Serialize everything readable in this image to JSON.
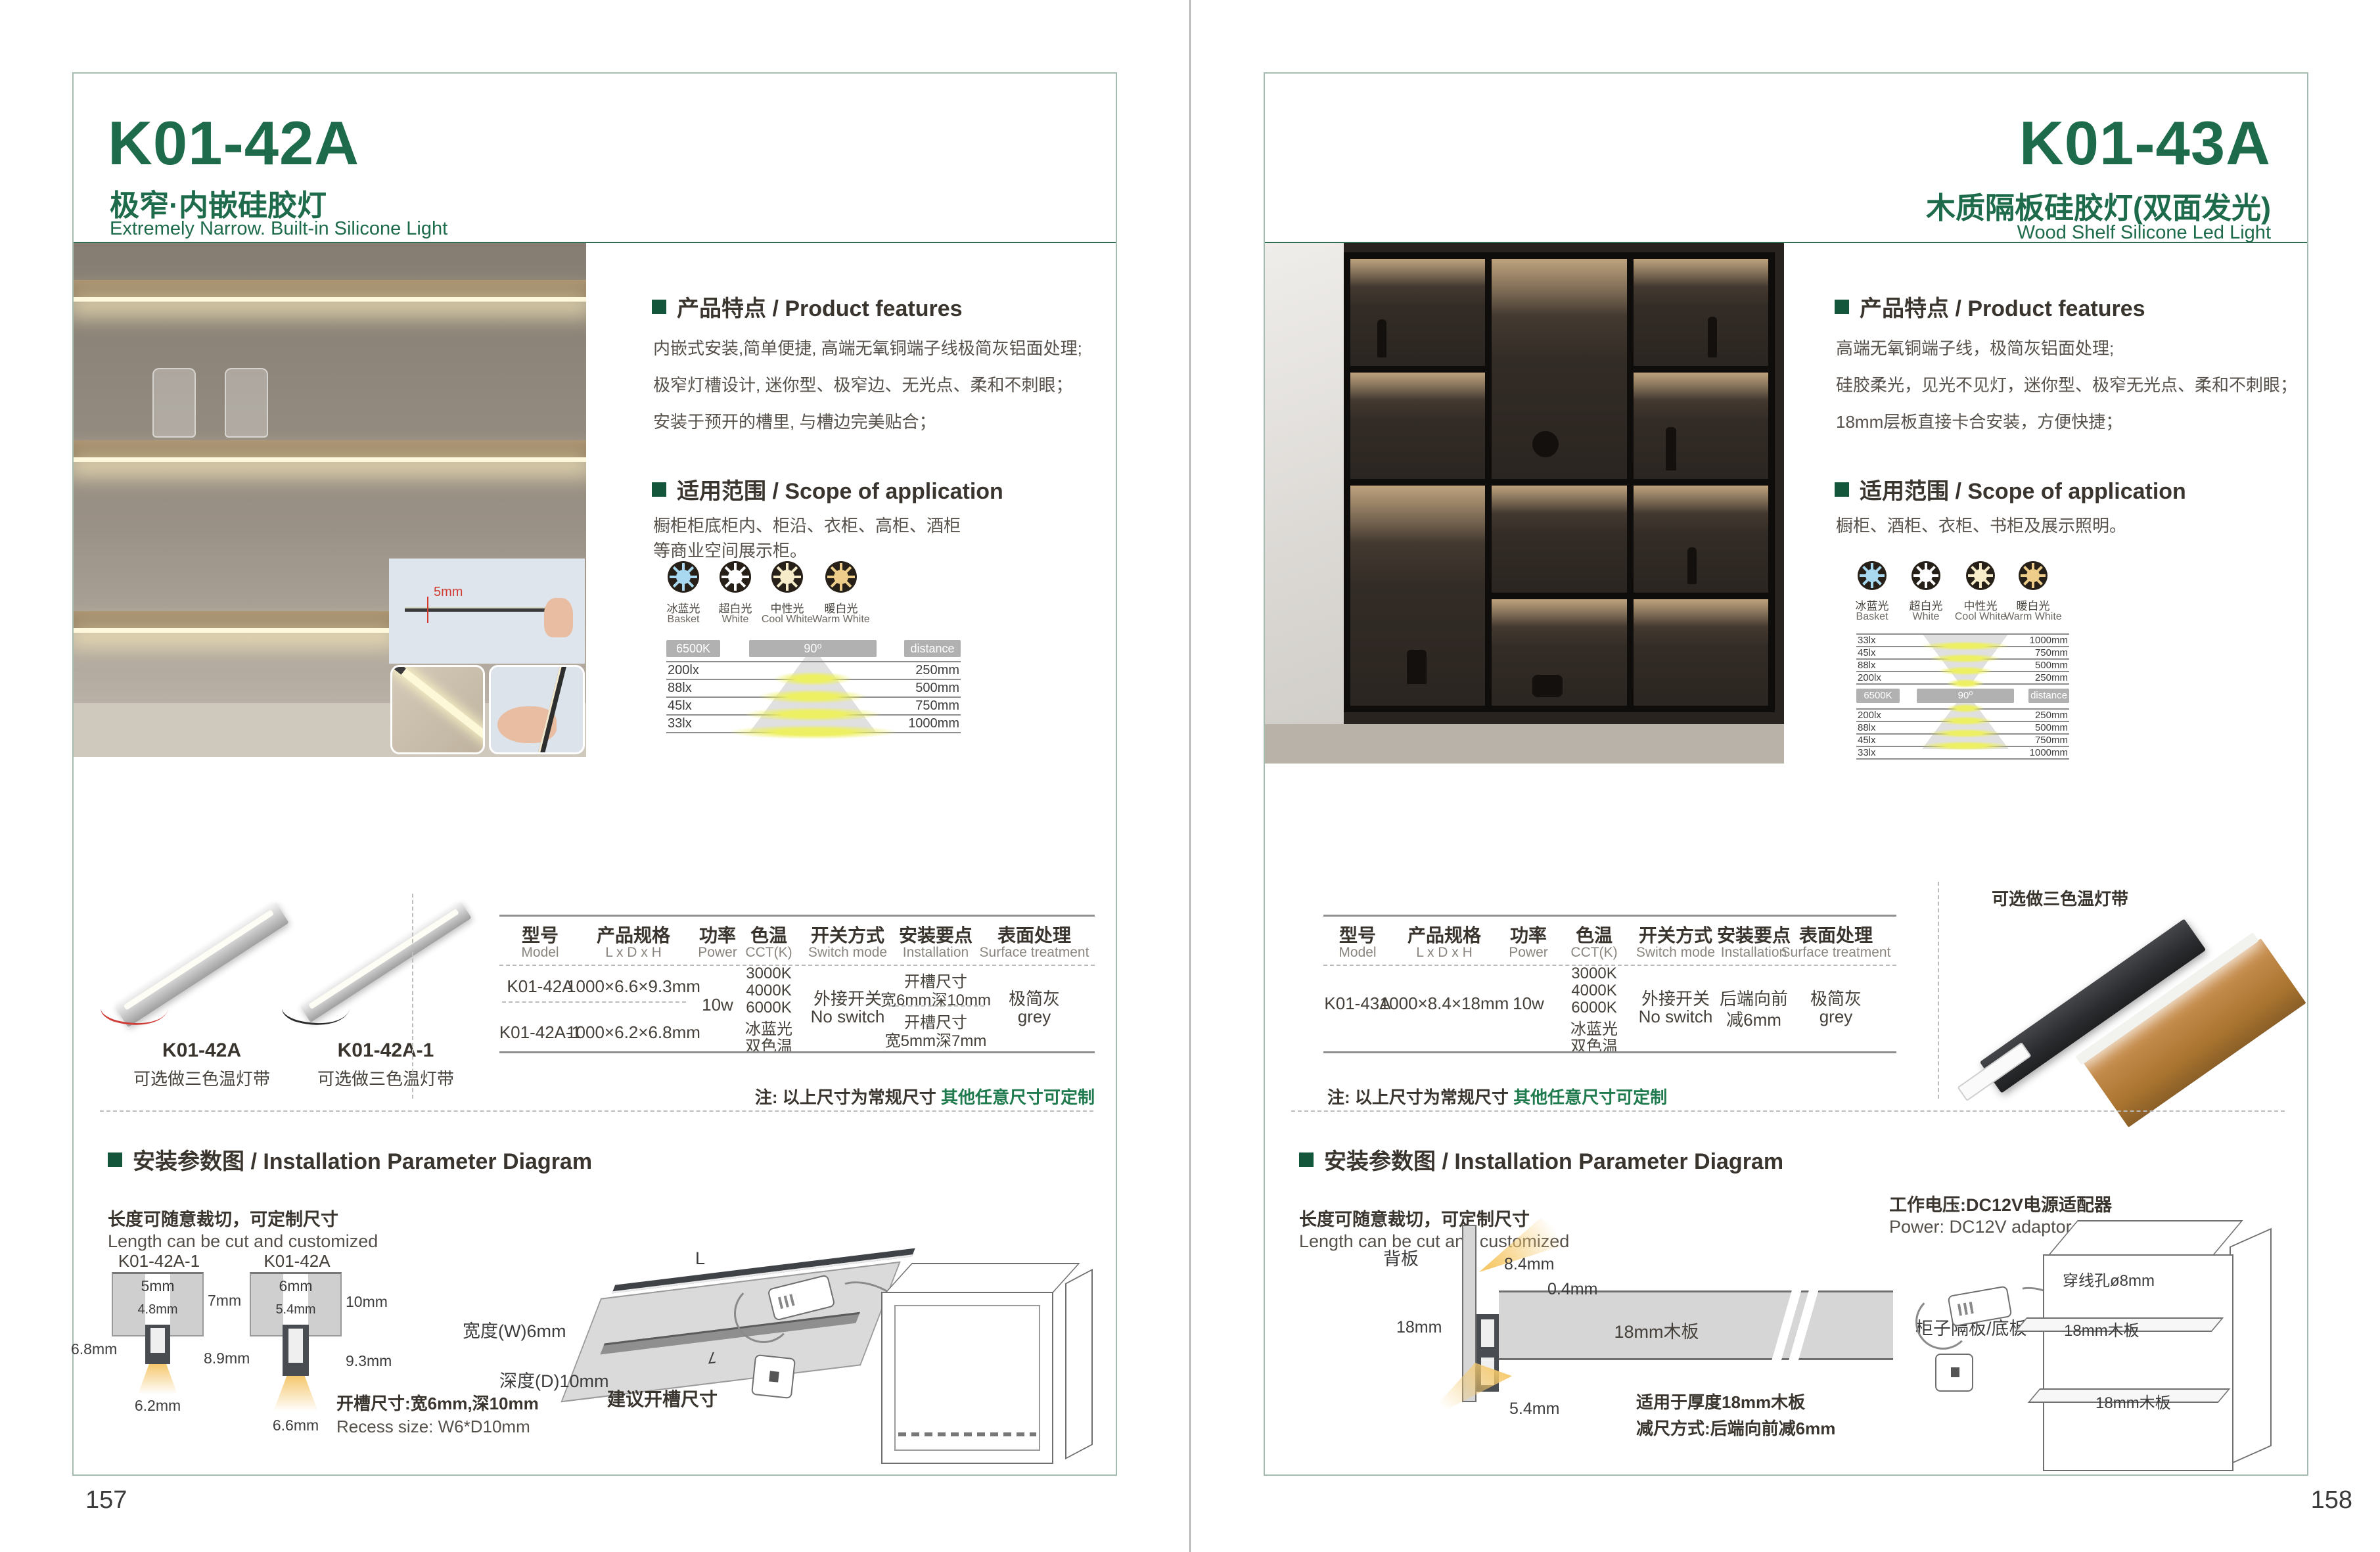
{
  "colors": {
    "green": "#1e6b4b"
  },
  "shared": {
    "features_header": "产品特点 / Product features",
    "scope_header": "适用范围 / Scope of application",
    "install_header": "安装参数图 / Installation Parameter Diagram",
    "cut_cn": "长度可随意裁切，可定制尺寸",
    "cut_en": "Length can be cut and customized",
    "note_black": "注: 以上尺寸为常规尺寸 ",
    "note_green": "其他任意尺寸可定制",
    "bar_cct": "6500K",
    "bar_angle": "90⁰",
    "bar_dist": "distance",
    "power": "10w",
    "switch1": "外接开关",
    "switch2": "No switch",
    "surface1": "极简灰",
    "surface2": "grey",
    "tricolor_note": "可选做三色温灯带",
    "cct_icons": [
      {
        "cn": "冰蓝光",
        "en": "Basket",
        "color": "#a9d9f0"
      },
      {
        "cn": "超白光",
        "en": "White",
        "color": "#ffffff"
      },
      {
        "cn": "中性光",
        "en": "Cool White",
        "color": "#f6ecca"
      },
      {
        "cn": "暖白光",
        "en": "Warm White",
        "color": "#eecd8a"
      }
    ],
    "headers": [
      {
        "cn": "型号",
        "en": "Model"
      },
      {
        "cn": "产品规格",
        "en": "L x D x H"
      },
      {
        "cn": "功率",
        "en": "Power"
      },
      {
        "cn": "色温",
        "en": "CCT(K)"
      },
      {
        "cn": "开关方式",
        "en": "Switch mode"
      },
      {
        "cn": "安装要点",
        "en": "Installation"
      },
      {
        "cn": "表面处理",
        "en": "Surface treatment"
      }
    ],
    "cct_values": [
      "3000K",
      "4000K",
      "6000K",
      "冰蓝光",
      "双色温"
    ]
  },
  "left": {
    "page_number": "157",
    "model": "K01-42A",
    "title_cn": "极窄·内嵌硅胶灯",
    "title_en": "Extremely Narrow. Built-in Silicone Light",
    "features": [
      "内嵌式安装,简单便捷, 高端无氧铜端子线极简灰铝面处理;",
      "极窄灯槽设计, 迷你型、极窄边、无光点、柔和不刺眼；",
      "安装于预开的槽里, 与槽边完美贴合；"
    ],
    "scope": [
      "橱柜柜底柜内、柜沿、衣柜、高柜、酒柜",
      "等商业空间展示柜。"
    ],
    "inset_dim": "5mm",
    "photometric": [
      {
        "lux": "200lx",
        "dist": "250mm"
      },
      {
        "lux": "88lx",
        "dist": "500mm"
      },
      {
        "lux": "45lx",
        "dist": "750mm"
      },
      {
        "lux": "33lx",
        "dist": "1000mm"
      }
    ],
    "products": [
      {
        "name": "K01-42A"
      },
      {
        "name": "K01-42A-1"
      }
    ],
    "rows": [
      {
        "model": "K01-42A",
        "size": "1000×6.6×9.3mm",
        "inst1": "开槽尺寸",
        "inst2": "宽6mm深10mm"
      },
      {
        "model": "K01-42A-1",
        "size": "1000×6.2×6.8mm",
        "inst1": "开槽尺寸",
        "inst2": "宽5mm深7mm"
      }
    ],
    "diagram1": {
      "name": "K01-42A-1",
      "top": "5mm",
      "inner": "4.8mm",
      "side": "7mm",
      "left": "6.8mm",
      "bottom": "6.2mm"
    },
    "diagram2": {
      "name": "K01-42A",
      "top": "6mm",
      "inner": "5.4mm",
      "side": "10mm",
      "left": "8.9mm",
      "side2": "9.3mm",
      "bottom": "6.6mm"
    },
    "board": {
      "w": "宽度(W)6mm",
      "d": "深度(D)10mm",
      "cap": "建议开槽尺寸",
      "L": "L"
    },
    "recess_cn": "开槽尺寸:宽6mm,深10mm",
    "recess_en": "Recess size: W6*D10mm"
  },
  "right": {
    "page_number": "158",
    "model": "K01-43A",
    "title_cn": "木质隔板硅胶灯(双面发光)",
    "title_en": "Wood Shelf Silicone Led Light",
    "features": [
      "高端无氧铜端子线，极简灰铝面处理;",
      "硅胶柔光，见光不见灯，迷你型、极窄无光点、柔和不刺眼；",
      "18mm层板直接卡合安装，方便快捷；"
    ],
    "scope": [
      "橱柜、酒柜、衣柜、书柜及展示照明。"
    ],
    "photo_top": [
      {
        "lux": "33lx",
        "dist": "1000mm"
      },
      {
        "lux": "45lx",
        "dist": "750mm"
      },
      {
        "lux": "88lx",
        "dist": "500mm"
      },
      {
        "lux": "200lx",
        "dist": "250mm"
      }
    ],
    "photo_bottom": [
      {
        "lux": "200lx",
        "dist": "250mm"
      },
      {
        "lux": "88lx",
        "dist": "500mm"
      },
      {
        "lux": "45lx",
        "dist": "750mm"
      },
      {
        "lux": "33lx",
        "dist": "1000mm"
      }
    ],
    "row": {
      "model": "K01-43A",
      "size": "1000×8.4×18mm",
      "inst1": "后端向前",
      "inst2": "减6mm"
    },
    "section": {
      "back": "背板",
      "a": "8.4mm",
      "b": "0.4mm",
      "c": "18mm",
      "d": "5.4mm",
      "board": "18mm木板",
      "board_label": "柜子隔板/底板",
      "fit1": "适用于厚度18mm木板",
      "fit2": "减尺方式:后端向前减6mm"
    },
    "cabinet": {
      "power_cn": "工作电压:DC12V电源适配器",
      "power_en": "Power: DC12V adaptor",
      "hole": "穿线孔ø8mm",
      "shelf1": "18mm木板",
      "shelf2": "18mm木板"
    }
  }
}
